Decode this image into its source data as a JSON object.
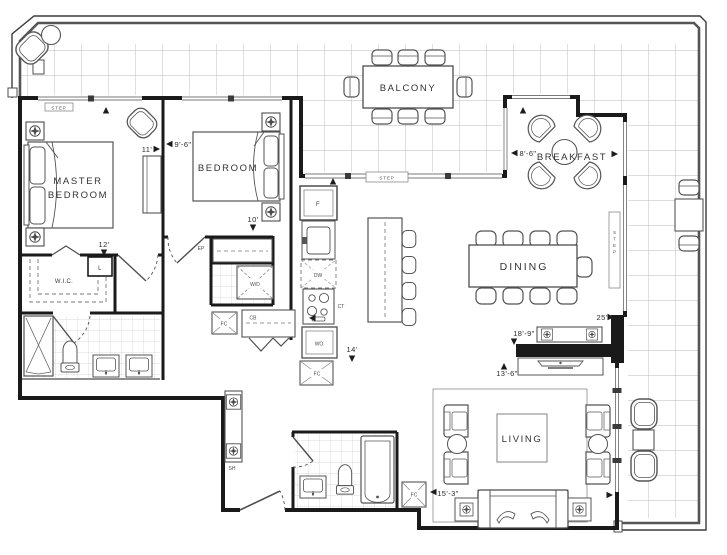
{
  "meta": {
    "title": "Two bedroom suite floor plan"
  },
  "rooms": {
    "master1": "MASTER",
    "master2": "BEDROOM",
    "bedroom": "BEDROOM",
    "balcony": "BALCONY",
    "breakfast": "BREAKFAST",
    "dining": "DINING",
    "living": "LIVING",
    "wic": "W.I.C."
  },
  "dims": {
    "master_w": "11'",
    "master_d": "12'",
    "bedroom_w": "9'-6\"",
    "bedroom_d": "10'",
    "breakfast_w": "8'-6\"",
    "kitchen_w": "14'",
    "terrace_e": "25'",
    "dining_w": "18'-9\"",
    "living_upper_w": "13'-6\"",
    "living_w": "15'-3\""
  },
  "tags": {
    "step": "STEP",
    "linen": "L",
    "ep": "EP",
    "wd": "W/D",
    "cb": "CB",
    "sh": "SH",
    "fc": "FC",
    "fridge": "F",
    "dw": "DW",
    "ct": "CT",
    "wo": "WO"
  },
  "colors": {
    "wall": "#1a1a1a",
    "furniture": "#4f4f4f",
    "grid": "#b8b8b8",
    "text": "#2e2e2e"
  }
}
